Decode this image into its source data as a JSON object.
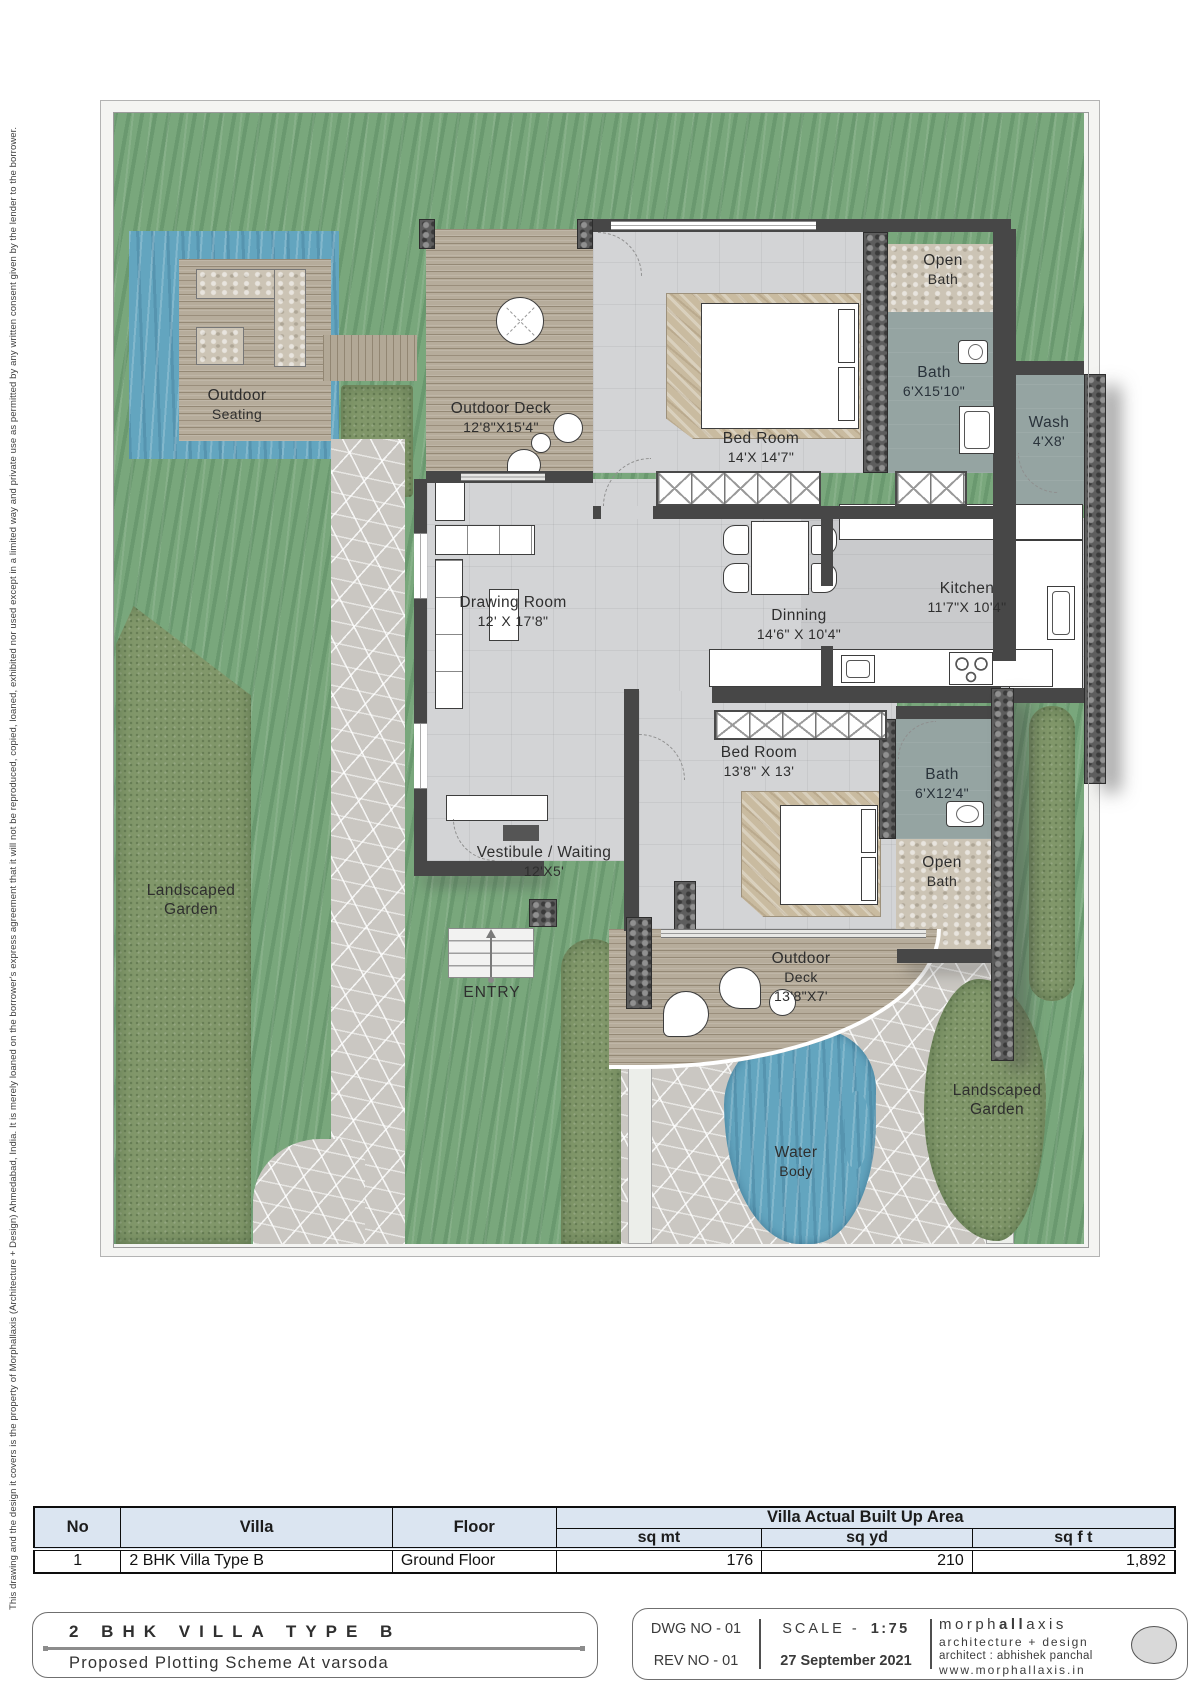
{
  "sheet": {
    "disclaimer": "This drawing and the design it covers is the property of Morphallaxis (Architecture + Design) Ahmedabad, India.  It is merely loaned on the borrower's express agreement that it will not be reproduced, copied, loaned, exhibited nor used except in a limited way and private use as permitted by any written consent given by the lender to the borrower."
  },
  "plan": {
    "outdoor_seating": {
      "l1": "Outdoor",
      "l2": "Seating"
    },
    "deck_top": {
      "l1": "Outdoor Deck",
      "l2": "12'8\"X15'4\""
    },
    "bedroom1": {
      "l1": "Bed Room",
      "l2": "14'X 14'7\""
    },
    "open_bath1": {
      "l1": "Open",
      "l2": "Bath"
    },
    "bath1": {
      "l1": "Bath",
      "l2": "6'X15'10\""
    },
    "wash": {
      "l1": "Wash",
      "l2": "4'X8'"
    },
    "kitchen": {
      "l1": "Kitchen",
      "l2": "11'7\"X 10'4\""
    },
    "dining": {
      "l1": "Dinning",
      "l2": "14'6\" X 10'4\""
    },
    "drawing_room": {
      "l1": "Drawing Room",
      "l2": "12' X 17'8\""
    },
    "vestibule": {
      "l1": "Vestibule / Waiting",
      "l2": "12'X5'"
    },
    "entry": {
      "l1": "ENTRY"
    },
    "bedroom2": {
      "l1": "Bed Room",
      "l2": "13'8\" X 13'"
    },
    "bath2": {
      "l1": "Bath",
      "l2": "6'X12'4\""
    },
    "open_bath2": {
      "l1": "Open",
      "l2": "Bath"
    },
    "deck_bottom": {
      "l1": "Outdoor",
      "l2": "Deck",
      "l3": "13'8\"X7'"
    },
    "water_body": {
      "l1": "Water",
      "l2": "Body"
    },
    "garden_left": {
      "l1": "Landscaped",
      "l2": "Garden"
    },
    "garden_right": {
      "l1": "Landscaped",
      "l2": "Garden"
    }
  },
  "area_table": {
    "col_no": "No",
    "col_villa": "Villa",
    "col_floor": "Floor",
    "col_builtup": "Villa Actual Built Up Area",
    "col_sqmt": "sq mt",
    "col_sqyd": "sq yd",
    "col_sqft": "sq f t",
    "rows": [
      {
        "no": "1",
        "villa": "2 BHK Villa Type B",
        "floor": "Ground Floor",
        "sqmt": "176",
        "sqyd": "210",
        "sqft": "1,892"
      }
    ]
  },
  "title_block": {
    "title": "2 BHK VILLA TYPE B",
    "subtitle": "Proposed Plotting Scheme At  varsoda",
    "dwg_no": "DWG NO - 01",
    "rev_no": "REV NO - 01",
    "scale_label": "SCALE -",
    "scale_value": "1:75",
    "date": "27 September 2021",
    "brand_pre": "morph",
    "brand_bold": "all",
    "brand_post": "axis",
    "brand_tagline": "architecture + design",
    "brand_architect": "architect : abhishek panchal",
    "brand_web": "www.morphallaxis.in"
  }
}
